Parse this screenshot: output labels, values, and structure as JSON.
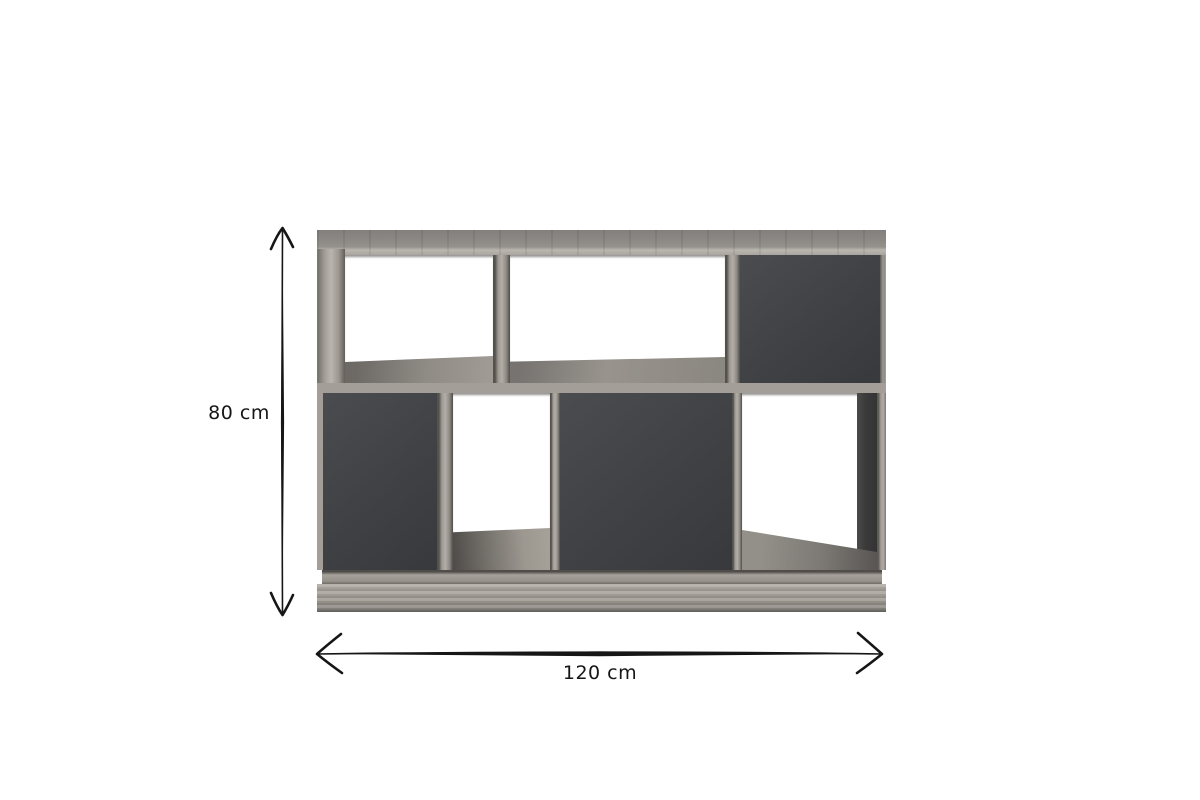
{
  "scene": {
    "type": "product-dimension-diagram",
    "product": "shelving unit with open niches and dark grey doors on a plinth base"
  },
  "dimensions": {
    "height": {
      "label": "80 cm",
      "value": 80,
      "unit": "cm"
    },
    "width": {
      "label": "120 cm",
      "value": 120,
      "unit": "cm"
    }
  },
  "icons": {
    "height_arrow": "double-headed-vertical-arrow",
    "width_arrow": "double-headed-horizontal-arrow"
  },
  "colors": {
    "background": "#ffffff",
    "ink": "#161616",
    "wood": "#9b968f",
    "wood_light": "#b6b1aa",
    "wood_dark": "#6f6c67",
    "door": "#3f4144",
    "interior_shadow": "#3a3a3a"
  },
  "structure": {
    "top_row": [
      "open",
      "open",
      "door"
    ],
    "bottom_row": [
      "door",
      "open",
      "door",
      "open"
    ],
    "base": "plinth"
  }
}
